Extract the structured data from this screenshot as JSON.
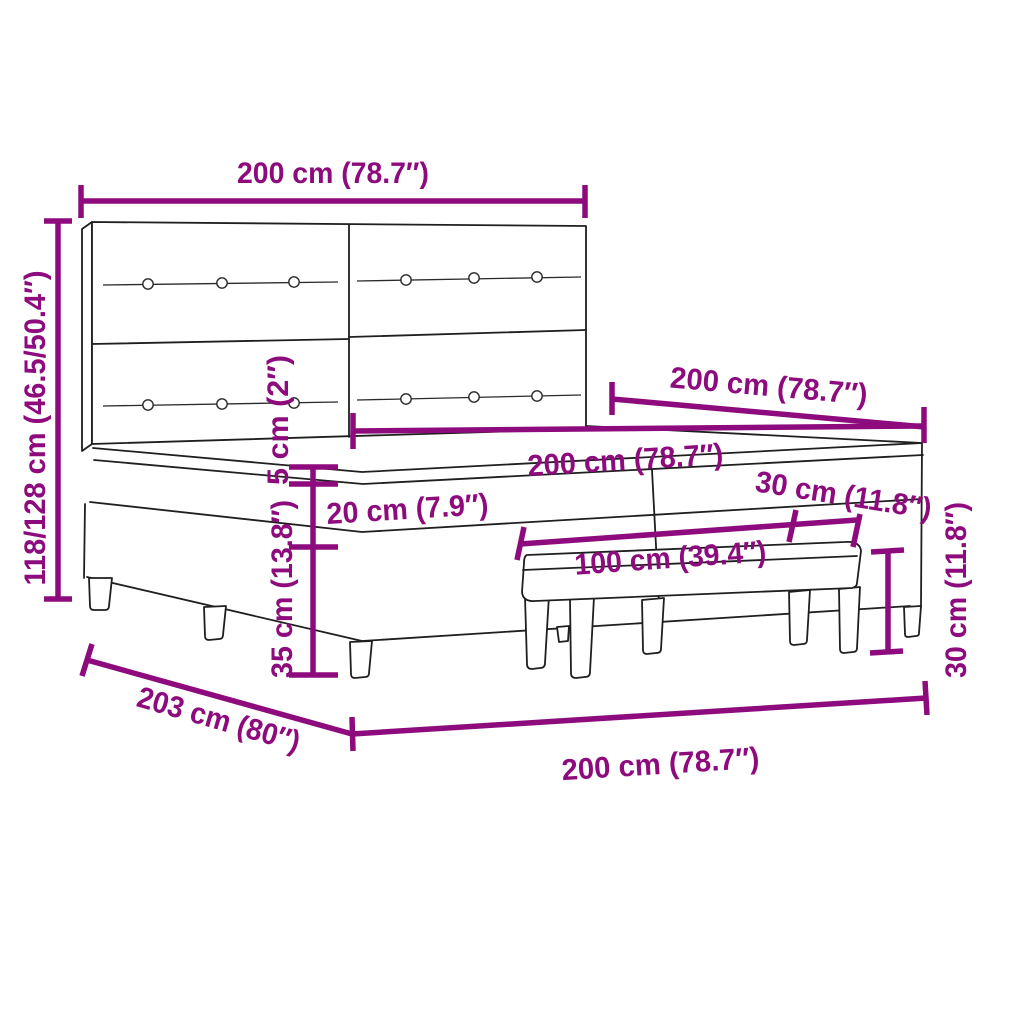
{
  "colors": {
    "accent": "#8d0b7d",
    "line": "#1f1f1f",
    "background": "#ffffff"
  },
  "diagram": {
    "subject": "box spring bed with upholstered button headboard, split mattress and bench",
    "dimensions": {
      "headboard_width": "200 cm (78.7″)",
      "overall_height": "118/128 cm (46.5/50.4″)",
      "bed_length": "200 cm (78.7″)",
      "mattress_width": "200 cm (78.7″)",
      "pillow_top_thickness": "5 cm (2″)",
      "mattress_thickness": "20 cm (7.9″)",
      "base_height": "35 cm (13.8″)",
      "bench_length": "100 cm (39.4″)",
      "bench_depth": "30 cm (11.8″)",
      "bench_height": "30 cm (11.8″)",
      "bed_depth": "203 cm (80″)",
      "bed_width": "200 cm (78.7″)"
    }
  }
}
